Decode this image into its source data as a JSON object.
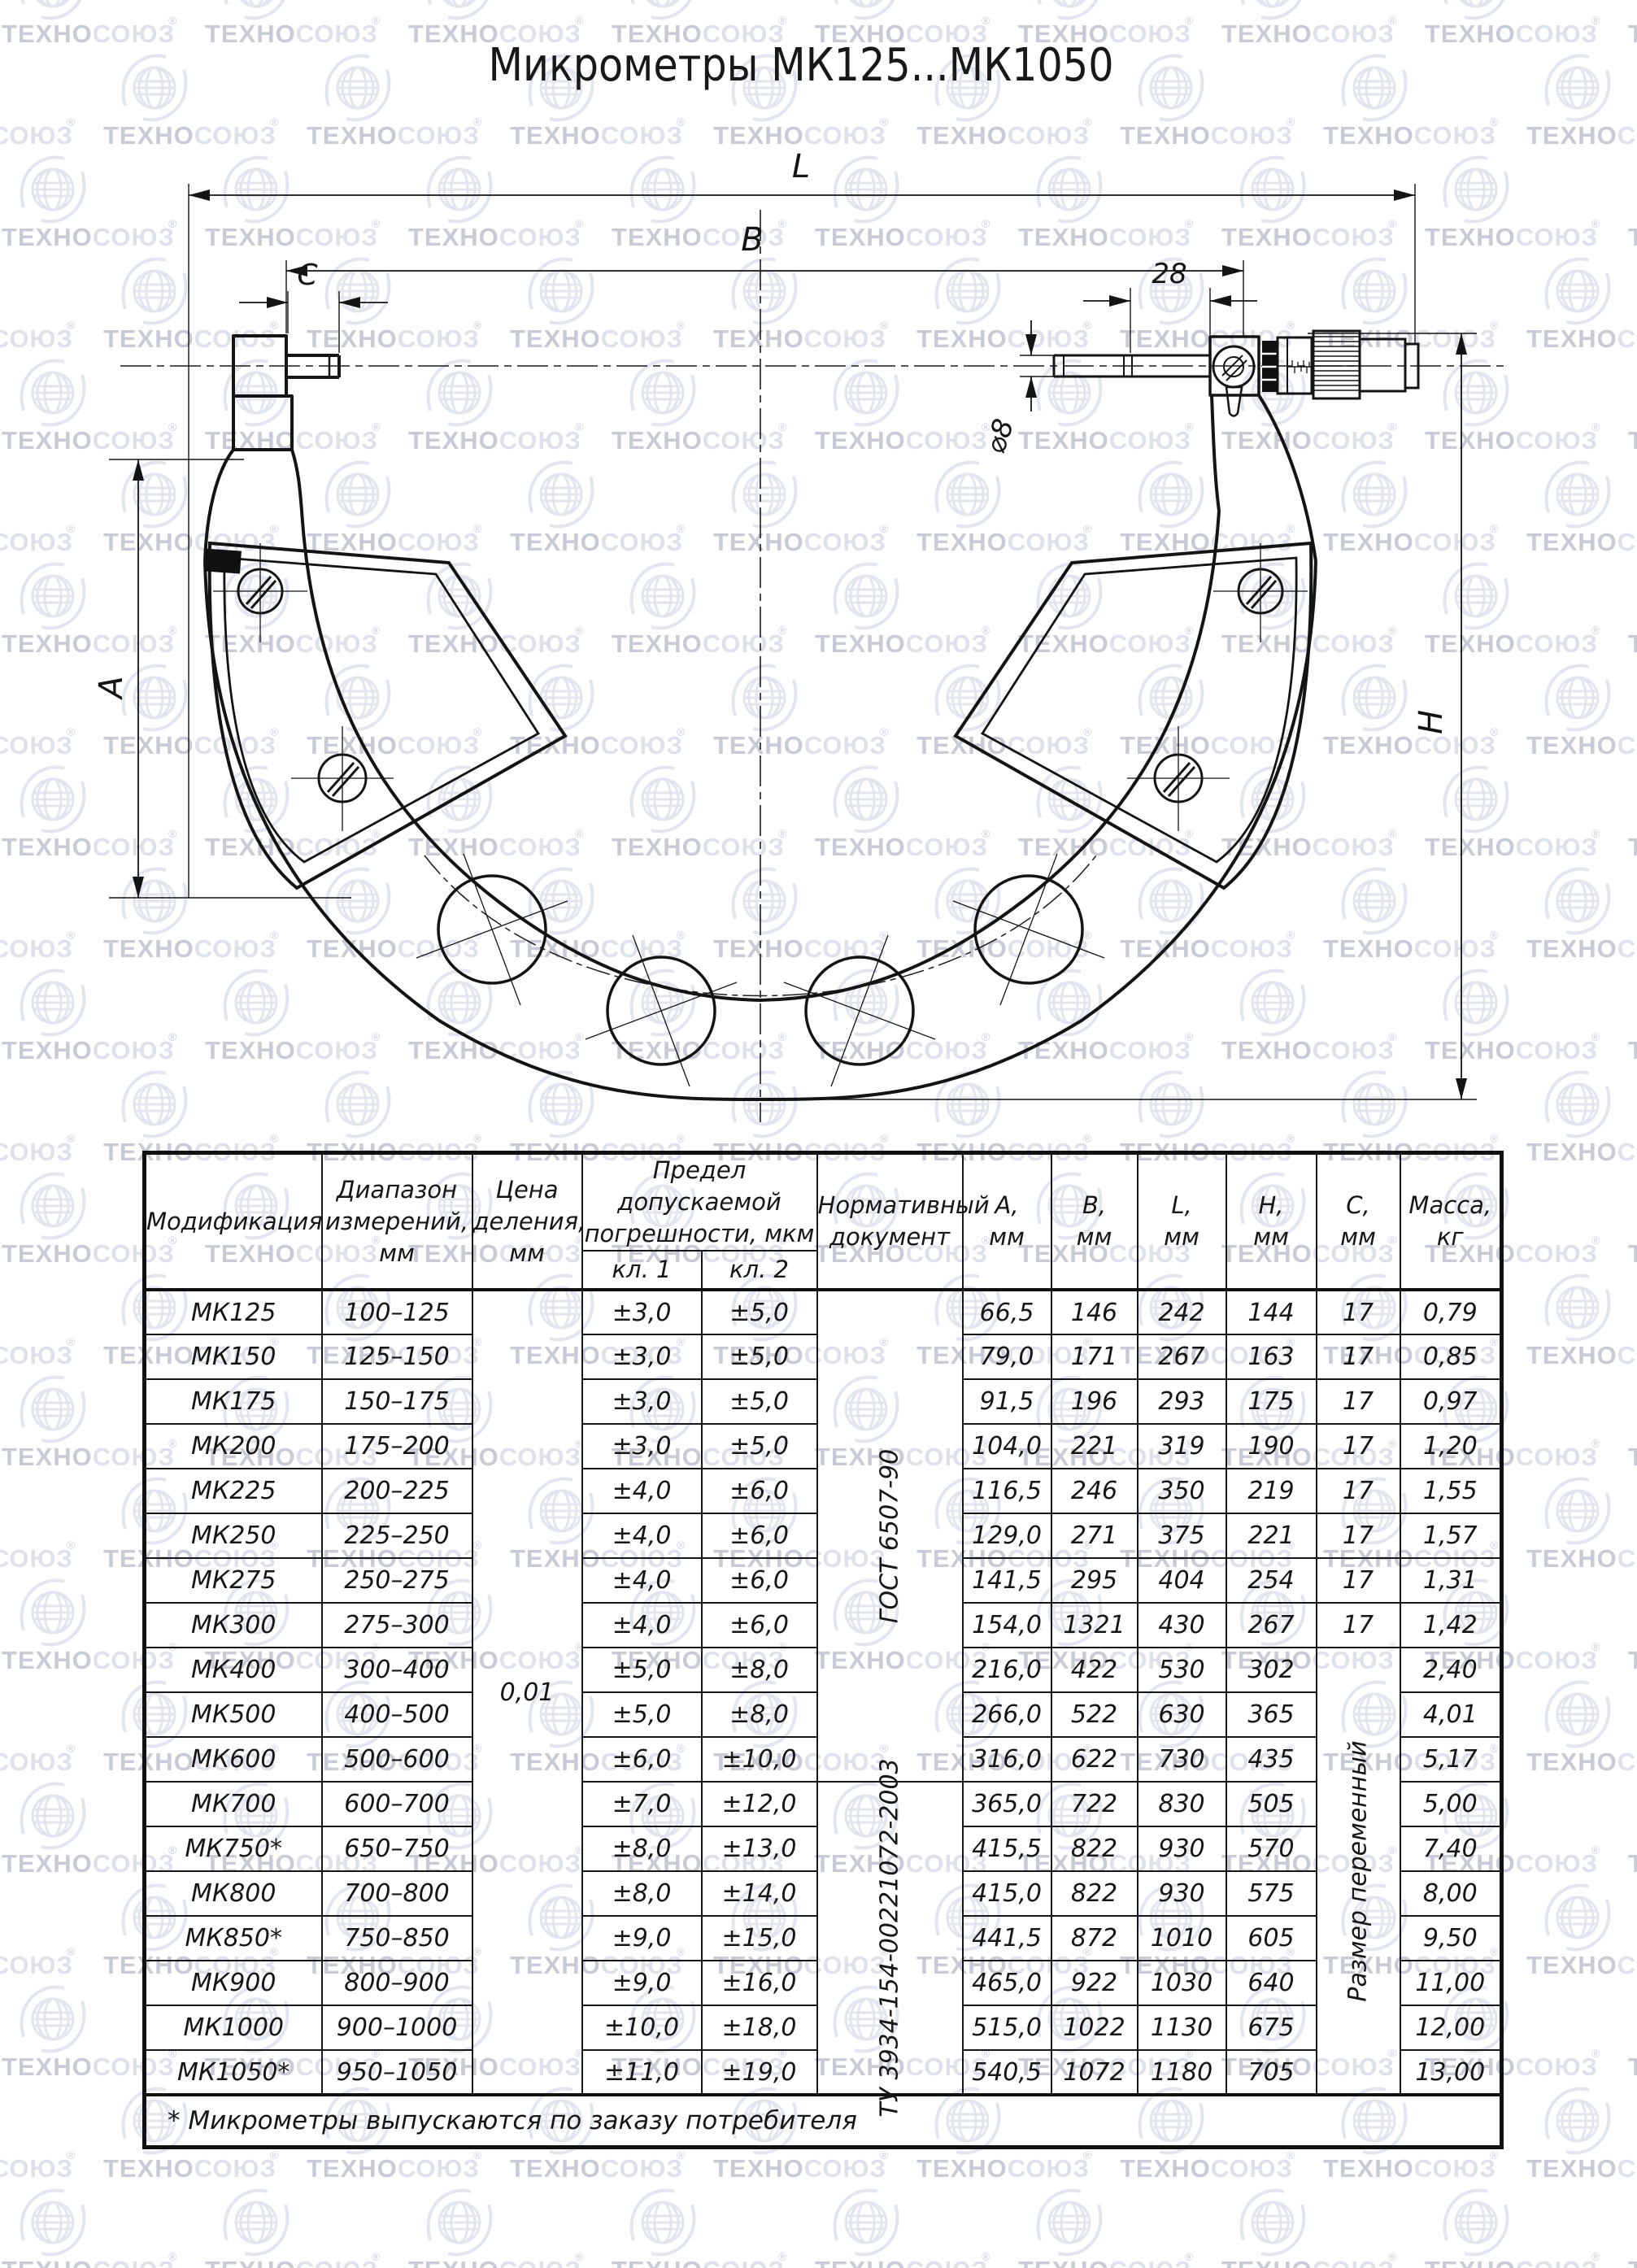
{
  "watermark": {
    "brand_left": "ТЕХНО",
    "brand_right": "СОЮЗ",
    "reg_mark": "®",
    "color_dark": "#c7cbd5",
    "color_light": "#dde1e9",
    "color_globe": "#e1e5ed"
  },
  "title": "Микрометры МК125...МК1050",
  "drawing": {
    "labels": {
      "l": "L",
      "b": "B",
      "c": "C",
      "offset_28": "28",
      "dia_8": "⌀8",
      "a": "A",
      "h": "H"
    }
  },
  "table": {
    "headers": {
      "modification": "Модификация",
      "range": "Диапазон\nизмерений,\nмм",
      "division": "Цена\nделения,\nмм",
      "tolerance": "Предел допускаемой\nпогрешности, мкм",
      "class1": "кл. 1",
      "class2": "кл. 2",
      "document": "Нормативный\nдокумент",
      "a": "А,\nмм",
      "b": "В,\nмм",
      "l": "L,\nмм",
      "h": "Н,\nмм",
      "c": "С,\nмм",
      "mass": "Масса,\nкг"
    },
    "merged": {
      "division": "0,01",
      "doc_gost": "ГОСТ 6507-90",
      "doc_tu": "ТУ 3934-154-00221072-2003",
      "c_variable": "Размер переменный"
    },
    "rows": [
      {
        "model": "МК125",
        "range": "100–125",
        "class1": "±3,0",
        "class2": "±5,0",
        "a": "66,5",
        "b": "146",
        "l": "242",
        "h": "144",
        "c": "17",
        "mass": "0,79"
      },
      {
        "model": "МК150",
        "range": "125–150",
        "class1": "±3,0",
        "class2": "±5,0",
        "a": "79,0",
        "b": "171",
        "l": "267",
        "h": "163",
        "c": "17",
        "mass": "0,85"
      },
      {
        "model": "МК175",
        "range": "150–175",
        "class1": "±3,0",
        "class2": "±5,0",
        "a": "91,5",
        "b": "196",
        "l": "293",
        "h": "175",
        "c": "17",
        "mass": "0,97"
      },
      {
        "model": "МК200",
        "range": "175–200",
        "class1": "±3,0",
        "class2": "±5,0",
        "a": "104,0",
        "b": "221",
        "l": "319",
        "h": "190",
        "c": "17",
        "mass": "1,20"
      },
      {
        "model": "МК225",
        "range": "200–225",
        "class1": "±4,0",
        "class2": "±6,0",
        "a": "116,5",
        "b": "246",
        "l": "350",
        "h": "219",
        "c": "17",
        "mass": "1,55"
      },
      {
        "model": "МК250",
        "range": "225–250",
        "class1": "±4,0",
        "class2": "±6,0",
        "a": "129,0",
        "b": "271",
        "l": "375",
        "h": "221",
        "c": "17",
        "mass": "1,57"
      },
      {
        "model": "МК275",
        "range": "250–275",
        "class1": "±4,0",
        "class2": "±6,0",
        "a": "141,5",
        "b": "295",
        "l": "404",
        "h": "254",
        "c": "17",
        "mass": "1,31"
      },
      {
        "model": "МК300",
        "range": "275–300",
        "class1": "±4,0",
        "class2": "±6,0",
        "a": "154,0",
        "b": "1321",
        "l": "430",
        "h": "267",
        "c": "17",
        "mass": "1,42"
      },
      {
        "model": "МК400",
        "range": "300–400",
        "class1": "±5,0",
        "class2": "±8,0",
        "a": "216,0",
        "b": "422",
        "l": "530",
        "h": "302",
        "mass": "2,40"
      },
      {
        "model": "МК500",
        "range": "400–500",
        "class1": "±5,0",
        "class2": "±8,0",
        "a": "266,0",
        "b": "522",
        "l": "630",
        "h": "365",
        "mass": "4,01"
      },
      {
        "model": "МК600",
        "range": "500–600",
        "class1": "±6,0",
        "class2": "±10,0",
        "a": "316,0",
        "b": "622",
        "l": "730",
        "h": "435",
        "mass": "5,17"
      },
      {
        "model": "МК700",
        "range": "600–700",
        "class1": "±7,0",
        "class2": "±12,0",
        "a": "365,0",
        "b": "722",
        "l": "830",
        "h": "505",
        "mass": "5,00"
      },
      {
        "model": "МК750*",
        "range": "650–750",
        "class1": "±8,0",
        "class2": "±13,0",
        "a": "415,5",
        "b": "822",
        "l": "930",
        "h": "570",
        "mass": "7,40"
      },
      {
        "model": "МК800",
        "range": "700–800",
        "class1": "±8,0",
        "class2": "±14,0",
        "a": "415,0",
        "b": "822",
        "l": "930",
        "h": "575",
        "mass": "8,00"
      },
      {
        "model": "МК850*",
        "range": "750–850",
        "class1": "±9,0",
        "class2": "±15,0",
        "a": "441,5",
        "b": "872",
        "l": "1010",
        "h": "605",
        "mass": "9,50"
      },
      {
        "model": "МК900",
        "range": "800–900",
        "class1": "±9,0",
        "class2": "±16,0",
        "a": "465,0",
        "b": "922",
        "l": "1030",
        "h": "640",
        "mass": "11,00"
      },
      {
        "model": "МК1000",
        "range": "900–1000",
        "class1": "±10,0",
        "class2": "±18,0",
        "a": "515,0",
        "b": "1022",
        "l": "1130",
        "h": "675",
        "mass": "12,00"
      },
      {
        "model": "МК1050*",
        "range": "950–1050",
        "class1": "±11,0",
        "class2": "±19,0",
        "a": "540,5",
        "b": "1072",
        "l": "1180",
        "h": "705",
        "mass": "13,00"
      }
    ],
    "footnote": "* Микрометры выпускаются по заказу потребителя"
  }
}
